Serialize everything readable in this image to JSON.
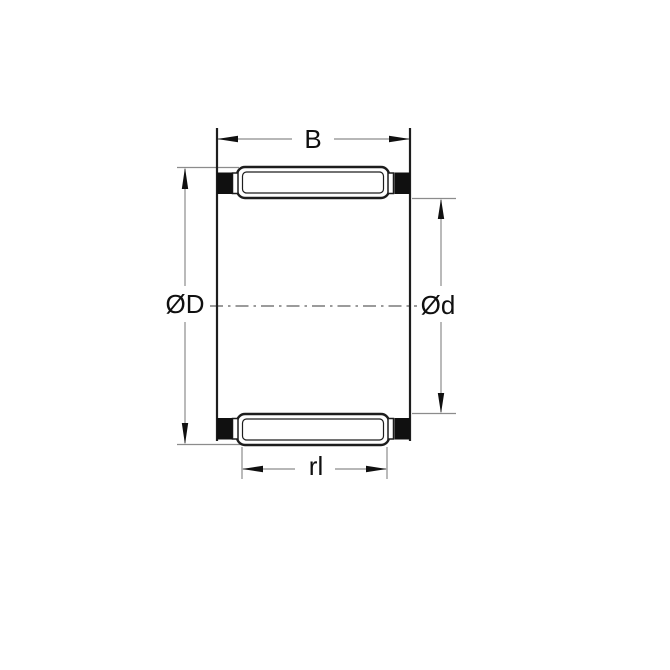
{
  "diagram": {
    "name": "needle-roller-bearing-cage-cross-section",
    "labels": {
      "width": "B",
      "outer_diameter": "ØD",
      "inner_diameter": "Ød",
      "roller_length": "rl"
    },
    "colors": {
      "background": "#ffffff",
      "outline": "#1d1d1d",
      "roller_fill": "#ffffff",
      "cage_block": "#101010",
      "dimension_line": "#8c8c8c",
      "centerline": "#5f5f5f",
      "arrow": "#101010",
      "label_text": "#101010"
    }
  }
}
